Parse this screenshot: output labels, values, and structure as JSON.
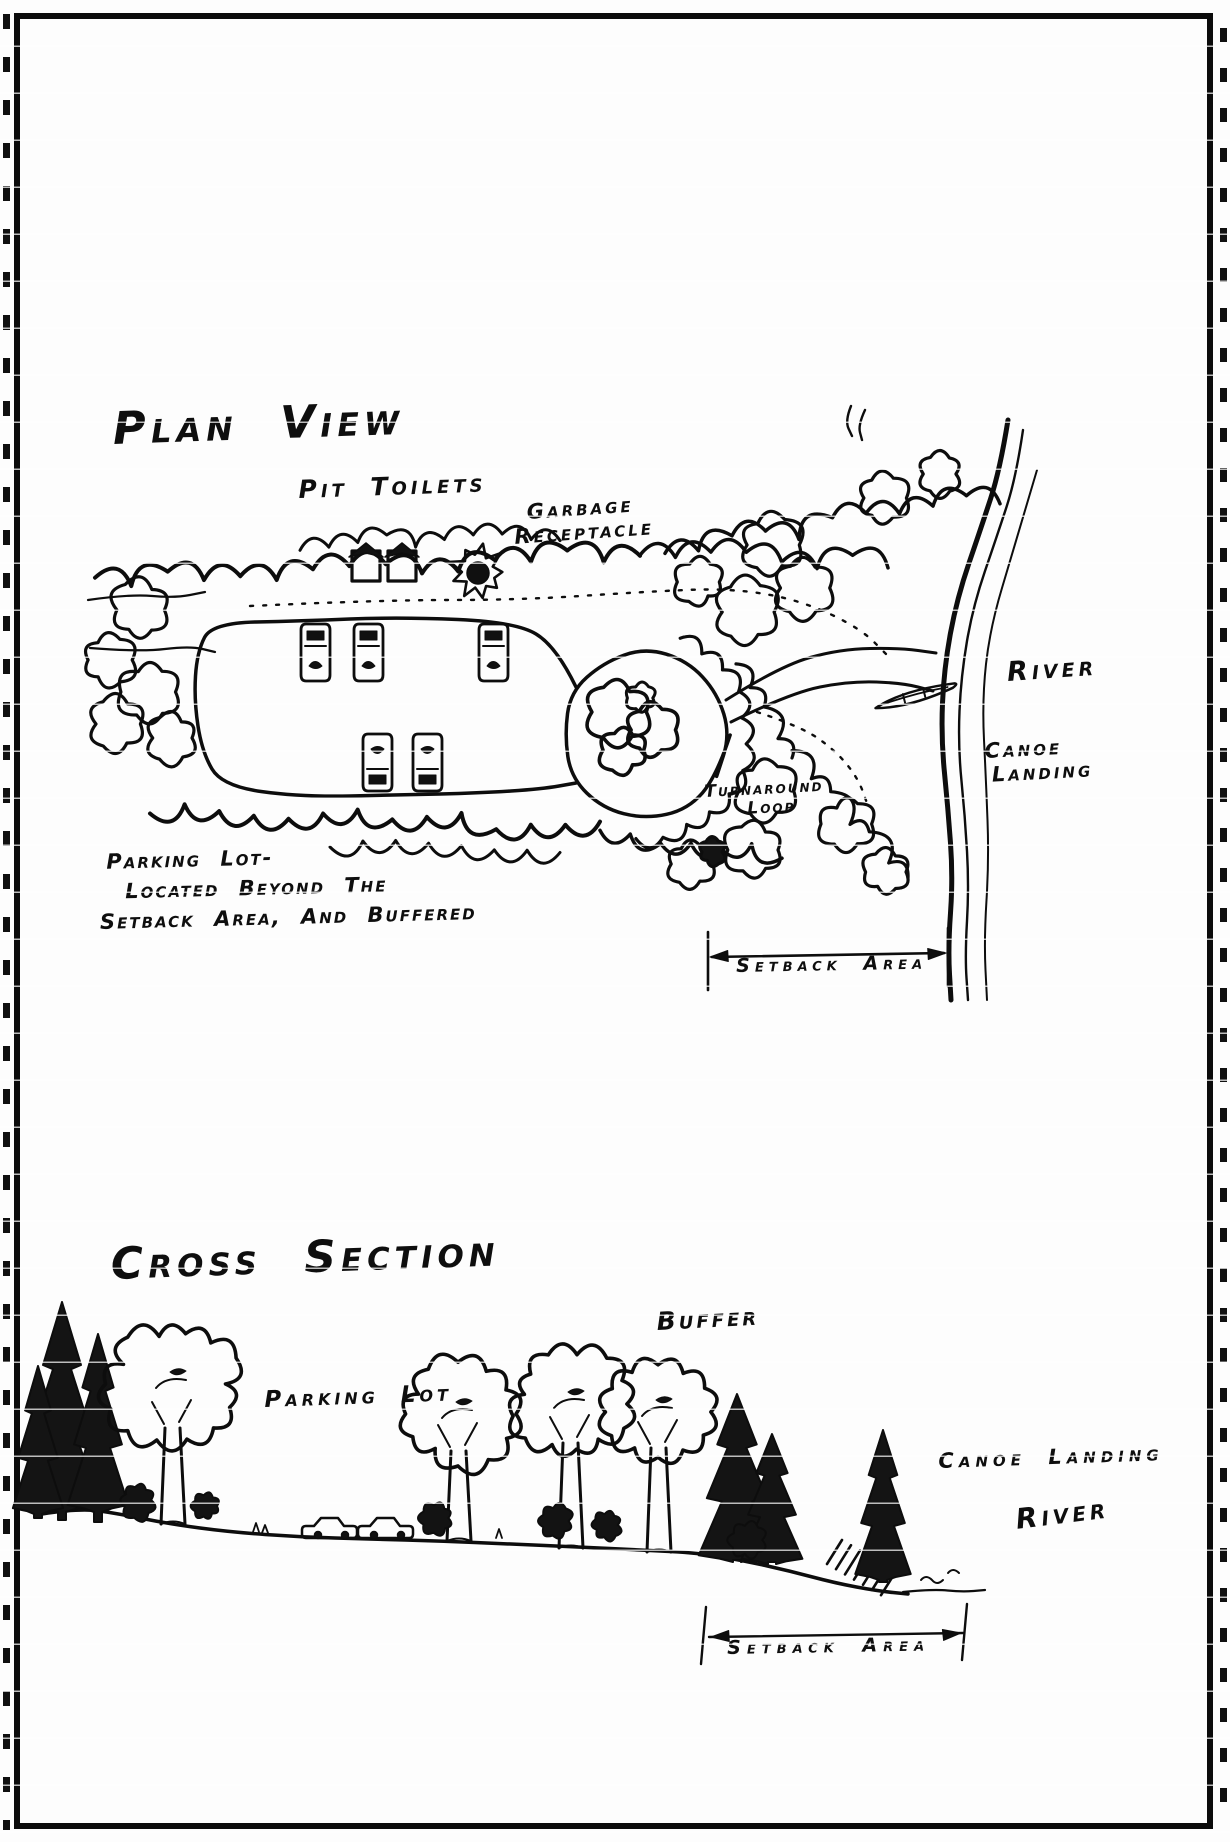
{
  "colors": {
    "ink": "#0e0e0e",
    "paper": "#fdfdfd"
  },
  "plan_view": {
    "title": "Plan View",
    "labels": {
      "pit_toilets": "Pit Toilets",
      "garbage_line1": "Garbage",
      "garbage_line2": "Receptacle",
      "river": "River",
      "canoe_line1": "Canoe",
      "canoe_line2": "Landing",
      "turnaround_line1": "Turnaround",
      "turnaround_line2": "Loop",
      "note_line1": "Parking Lot-",
      "note_line2": "Located Beyond The",
      "note_line3": "Setback Area, And Buffered",
      "setback": "Setback Area"
    }
  },
  "cross_section": {
    "title": "Cross Section",
    "labels": {
      "buffer": "Buffer",
      "parking_lot": "Parking Lot",
      "canoe_landing": "Canoe Landing",
      "river": "River",
      "setback": "Setback Area"
    }
  }
}
